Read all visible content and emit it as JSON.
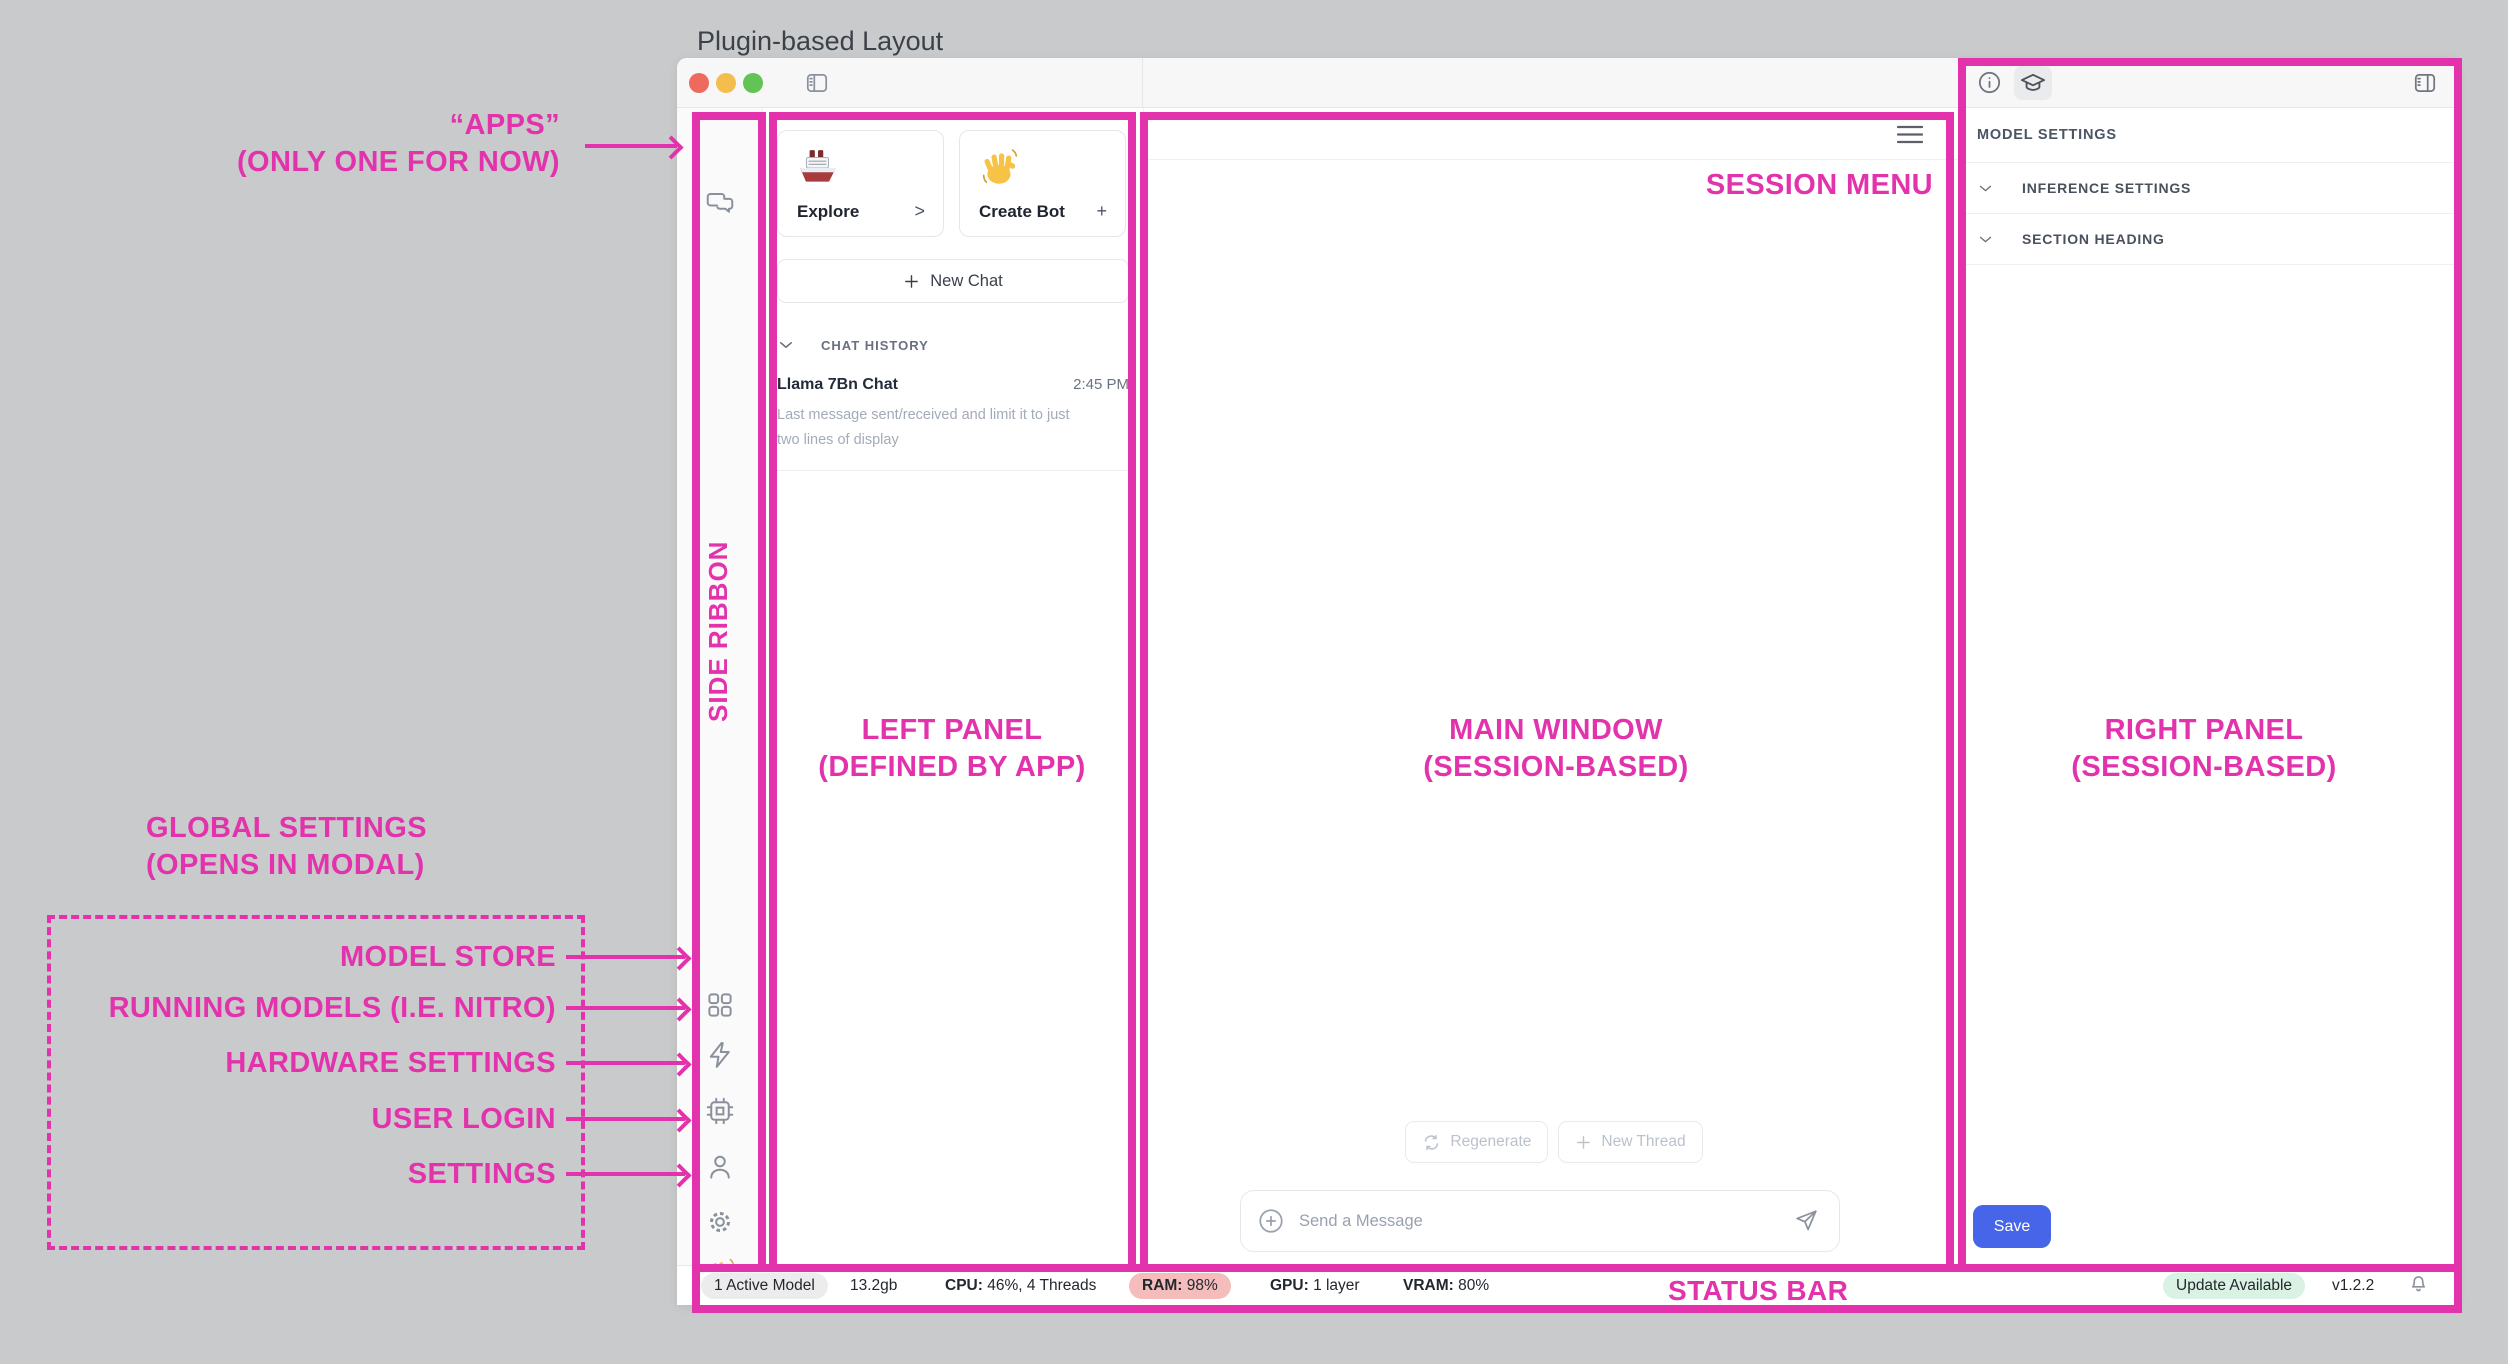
{
  "page_title": "Plugin-based Layout",
  "colors": {
    "accent_pink": "#E233AC",
    "save_blue": "#4765E8",
    "ram_warning_bg": "#F4BCBB",
    "update_pill_bg": "#D9F2E3",
    "traffic_red": "#EE6A5E",
    "traffic_yellow": "#F4BE4F",
    "traffic_green": "#61C454"
  },
  "annotations": {
    "apps_line1": "“APPS”",
    "apps_line2": "(ONLY ONE FOR NOW)",
    "side_ribbon": "SIDE RIBBON",
    "left_panel": {
      "line1": "LEFT PANEL",
      "line2": "(DEFINED BY APP)"
    },
    "main_window": {
      "line1": "MAIN WINDOW",
      "line2": "(SESSION-BASED)"
    },
    "right_panel": {
      "line1": "RIGHT PANEL",
      "line2": "(SESSION-BASED)"
    },
    "session_menu": "SESSION MENU",
    "status_bar": "STATUS BAR",
    "global_settings": {
      "line1": "GLOBAL SETTINGS",
      "line2": "(OPENS IN MODAL)"
    },
    "global_items": [
      "MODEL STORE",
      "RUNNING MODELS (I.E. NITRO)",
      "HARDWARE SETTINGS",
      "USER LOGIN",
      "SETTINGS"
    ]
  },
  "left_panel": {
    "cards": [
      {
        "emoji": "ship-emoji",
        "label": "Explore",
        "accessory": ">"
      },
      {
        "emoji": "wave-emoji",
        "label": "Create Bot",
        "accessory": "+"
      }
    ],
    "new_chat": "New Chat",
    "chat_history": "CHAT HISTORY",
    "chat": {
      "title": "Llama 7Bn Chat",
      "time": "2:45 PM",
      "preview_line1": "Last message sent/received and limit it to just",
      "preview_line2": "two lines of display"
    }
  },
  "main_window": {
    "regenerate": "Regenerate",
    "new_thread": "New Thread",
    "message_placeholder": "Send a Message"
  },
  "right_panel": {
    "model_settings": "MODEL SETTINGS",
    "sections": [
      "INFERENCE SETTINGS",
      "SECTION HEADING"
    ],
    "save": "Save"
  },
  "status_bar": {
    "active_model": "1 Active Model",
    "size": "13.2gb",
    "cpu_label": "CPU:",
    "cpu_value": "46%, 4 Threads",
    "ram_label": "RAM:",
    "ram_value": "98%",
    "gpu_label": "GPU:",
    "gpu_value": "1 layer",
    "vram_label": "VRAM:",
    "vram_value": "80%",
    "update": "Update Available",
    "version": "v1.2.2"
  }
}
